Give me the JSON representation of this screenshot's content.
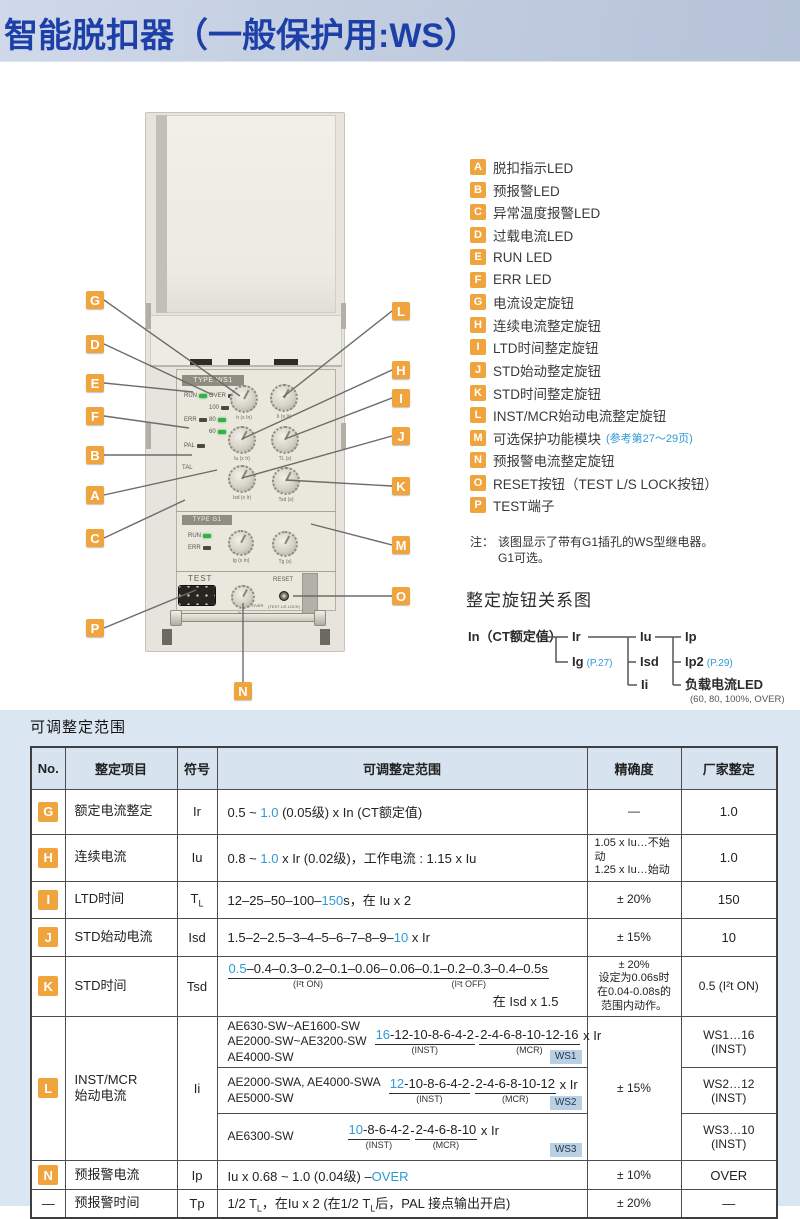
{
  "page": {
    "title": "智能脱扣器（一般保护用:WS）"
  },
  "colors": {
    "accent_orange": "#F0A43E",
    "accent_blue": "#2E9AD5",
    "title_blue": "#1D3FA8",
    "panel_blue": "#DAE7F3"
  },
  "device": {
    "type_ws1": "TYPE WS1",
    "type_g1": "TYPE G1",
    "leds_ws1": {
      "run": "RUN",
      "over": "OVER",
      "v100": "100",
      "err": "ERR",
      "v80": "80",
      "v60": "60",
      "pal": "PAL",
      "tal": "TAL"
    },
    "knobs_ws1": [
      "Ir (x In)",
      "Ii (x Ir)",
      "Iu (x Ir)",
      "TL (s)",
      "Isd (x Ir)",
      "Tsd (s)"
    ],
    "leds_g1": {
      "run": "RUN",
      "err": "ERR"
    },
    "knobs_g1": [
      "Ig (x In)",
      "Tg (s)"
    ],
    "test": "TEST",
    "reset": "RESET",
    "reset_sub": "(TEST L/S LOCK)",
    "n_knob": "Ip",
    "n_over": "OVER"
  },
  "callouts": {
    "letters": [
      "G",
      "D",
      "E",
      "F",
      "B",
      "A",
      "C",
      "P",
      "L",
      "H",
      "I",
      "J",
      "K",
      "M",
      "O",
      "N"
    ]
  },
  "legend": {
    "items": [
      {
        "key": "A",
        "label": "脱扣指示LED"
      },
      {
        "key": "B",
        "label": "预报警LED"
      },
      {
        "key": "C",
        "label": "异常温度报警LED"
      },
      {
        "key": "D",
        "label": "过载电流LED"
      },
      {
        "key": "E",
        "label": "RUN LED"
      },
      {
        "key": "F",
        "label": "ERR LED"
      },
      {
        "key": "G",
        "label": "电流设定旋钮"
      },
      {
        "key": "H",
        "label": "连续电流整定旋钮"
      },
      {
        "key": "I",
        "label": "LTD时间整定旋钮"
      },
      {
        "key": "J",
        "label": "STD始动整定旋钮"
      },
      {
        "key": "K",
        "label": "STD时间整定旋钮"
      },
      {
        "key": "L",
        "label": "INST/MCR始动电流整定旋钮"
      },
      {
        "key": "M",
        "label": "可选保护功能模块",
        "note": "(参考第27～29页)"
      },
      {
        "key": "N",
        "label": "预报警电流整定旋钮"
      },
      {
        "key": "O",
        "label": "RESET按钮（TEST L/S LOCK按钮）"
      },
      {
        "key": "P",
        "label": "TEST端子"
      }
    ]
  },
  "note": {
    "label": "注：",
    "line1": "该图显示了带有G1插孔的WS型继电器。",
    "line2": "G1可选。"
  },
  "diagram": {
    "title": "整定旋钮关系图",
    "root": "In（CT额定值）",
    "ir": "Ir",
    "ig": "Ig",
    "ig_ref": "(P.27)",
    "iu": "Iu",
    "isd": "Isd",
    "ii": "Ii",
    "ip": "Ip",
    "ip2": "Ip2",
    "ip2_ref": "(P.29)",
    "led": "负载电流LED",
    "led_note": "(60, 80, 100%, OVER)"
  },
  "table": {
    "section_title": "可调整定范围",
    "headers": [
      "No.",
      "整定项目",
      "符号",
      "可调整整定范围",
      "精确度",
      "厂家整定"
    ],
    "headers_fix": {
      "h0": "No.",
      "h1": "整定项目",
      "h2": "符号",
      "h3": "可调整定范围",
      "h4": "精确度",
      "h5": "厂家整定"
    },
    "rows": {
      "g": {
        "no": "G",
        "item": "额定电流整定",
        "sym": "Ir",
        "range_pre": "0.5 ~ ",
        "range_blue": "1.0",
        "range_post": " (0.05级) x In (CT额定值)",
        "acc": "—",
        "factory": "1.0"
      },
      "h": {
        "no": "H",
        "item": "连续电流",
        "sym": "Iu",
        "range_pre": "0.8 ~ ",
        "range_blue": "1.0",
        "range_post": " x Ir (0.02级)，工作电流 : 1.15 x Iu",
        "acc1": "1.05 x Iu…不始动",
        "acc2": "1.25 x Iu…始动",
        "factory": "1.0"
      },
      "i": {
        "no": "I",
        "item": "LTD时间",
        "sym_main": "T",
        "sym_sub": "L",
        "range_pre": "12–25–50–100–",
        "range_blue": "150",
        "range_post": "s，在 Iu x 2",
        "acc": "± 20%",
        "factory": "150"
      },
      "j": {
        "no": "J",
        "item": "STD始动电流",
        "sym": "Isd",
        "range_pre": "1.5–2–2.5–3–4–5–6–7–8–9–",
        "range_blue": "10",
        "range_post": " x Ir",
        "acc": "± 15%",
        "factory": "10"
      },
      "k": {
        "no": "K",
        "item": "STD时间",
        "sym": "Tsd",
        "g1_blue": "0.5",
        "g1_rest": "–0.4–0.3–0.2–0.1–0.06–",
        "g1_label": "(I²t ON)",
        "g2": "0.06–0.1–0.2–0.3–0.4–0.5s",
        "g2_label": "(I²t OFF)",
        "note": "在 Isd x 1.5",
        "acc1": "± 20%",
        "acc2": "设定为0.06s时",
        "acc3": "在0.04-0.08s的",
        "acc4": "范围内动作。",
        "factory": "0.5 (I²t ON)"
      },
      "l": {
        "no": "L",
        "item1": "INST/MCR",
        "item2": "始动电流",
        "sym": "Ii",
        "acc": "± 15%",
        "subs": [
          {
            "models": [
              "AE630-SW~AE1600-SW",
              "AE2000-SW~AE3200-SW",
              "AE4000-SW"
            ],
            "blue": "16",
            "g1rest": "-12-10-8-6-4-2",
            "mid": "-",
            "g2": "2-4-6-8-10-12-16",
            "suffix": " x Ir",
            "l1": "(INST)",
            "l2": "(MCR)",
            "tag": "WS1",
            "factory": "WS1…16 (INST)"
          },
          {
            "models": [
              "AE2000-SWA, AE4000-SWA",
              "AE5000-SW"
            ],
            "blue": "12",
            "g1rest": "-10-8-6-4-2",
            "mid": "-",
            "g2": "2-4-6-8-10-12",
            "suffix": " x Ir",
            "l1": "(INST)",
            "l2": "(MCR)",
            "tag": "WS2",
            "factory": "WS2…12 (INST)"
          },
          {
            "models": [
              "AE6300-SW"
            ],
            "blue": "10",
            "g1rest": "-8-6-4-2",
            "mid": "-",
            "g2": "2-4-6-8-10",
            "suffix": " x Ir",
            "l1": "(INST)",
            "l2": "(MCR)",
            "tag": "WS3",
            "factory": "WS3…10 (INST)"
          }
        ]
      },
      "n": {
        "no": "N",
        "item": "预报警电流",
        "sym": "Ip",
        "range_pre": "Iu x 0.68 ~ 1.0 (0.04级) –",
        "range_blue": "OVER",
        "range_post": "",
        "acc": "± 10%",
        "factory": "OVER"
      },
      "tp": {
        "no": "—",
        "item": "预报警时间",
        "sym": "Tp",
        "r1": "1/2 T",
        "sub": "L",
        "r2": "，在Iu x 2 (在1/2 T",
        "r3": "后，PAL 接点输出开启)",
        "acc": "± 20%",
        "factory": "—"
      }
    }
  }
}
